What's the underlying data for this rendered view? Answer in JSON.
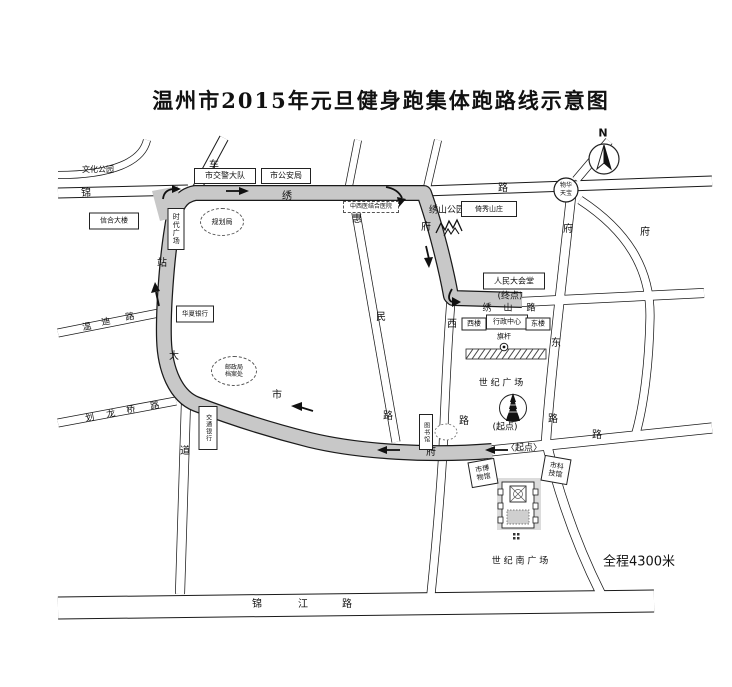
{
  "title": "温州市2015年元旦健身跑集体跑路线示意图",
  "map": {
    "route_color": "#c8c8c8",
    "road_color": "#ffffff",
    "labels": [
      {
        "n": "culture-park-label",
        "t": "文化公园",
        "x": 98,
        "y": 170,
        "fs": 8
      },
      {
        "n": "chezhan-dadao-char-1",
        "t": "车",
        "x": 214,
        "y": 166,
        "fs": 10
      },
      {
        "n": "jinxiu-lu-char-1",
        "t": "锦",
        "x": 86,
        "y": 194,
        "fs": 10
      },
      {
        "n": "jinxiu-lu-char-2",
        "t": "绣",
        "x": 287,
        "y": 197,
        "fs": 10
      },
      {
        "n": "jinxiu-lu-char-3",
        "t": "路",
        "x": 503,
        "y": 189,
        "fs": 10
      },
      {
        "n": "chezhan-dadao-char-2",
        "t": "站",
        "x": 162,
        "y": 264,
        "fs": 10
      },
      {
        "n": "chezhan-dadao-char-3",
        "t": "大",
        "x": 174,
        "y": 357,
        "fs": 10
      },
      {
        "n": "chezhan-dadao-char-4",
        "t": "道",
        "x": 185,
        "y": 452,
        "fs": 10
      },
      {
        "n": "wendi-lu-char-1",
        "t": "温",
        "x": 87,
        "y": 328,
        "fs": 9,
        "r": -10
      },
      {
        "n": "wendi-lu-char-2",
        "t": "迪",
        "x": 106,
        "y": 323,
        "fs": 9,
        "r": -10
      },
      {
        "n": "wendi-lu-char-3",
        "t": "路",
        "x": 130,
        "y": 318,
        "fs": 9,
        "r": -10
      },
      {
        "n": "hualongqiao-lu-char-1",
        "t": "划",
        "x": 90,
        "y": 419,
        "fs": 9,
        "r": -10
      },
      {
        "n": "hualongqiao-lu-char-2",
        "t": "龙",
        "x": 111,
        "y": 415,
        "fs": 9,
        "r": -10
      },
      {
        "n": "hualongqiao-lu-char-3",
        "t": "桥",
        "x": 131,
        "y": 411,
        "fs": 9,
        "r": -10
      },
      {
        "n": "hualongqiao-lu-char-4",
        "t": "路",
        "x": 155,
        "y": 407,
        "fs": 9,
        "r": -10
      },
      {
        "n": "shifu-lu-char-1",
        "t": "市",
        "x": 277,
        "y": 396,
        "fs": 10
      },
      {
        "n": "shifu-lu-char-2",
        "t": "府",
        "x": 431,
        "y": 453,
        "fs": 10
      },
      {
        "n": "shifu-lu-char-3",
        "t": "路",
        "x": 597,
        "y": 436,
        "fs": 10
      },
      {
        "n": "huimin-lu-char-1",
        "t": "惠",
        "x": 357,
        "y": 220,
        "fs": 10
      },
      {
        "n": "huimin-lu-char-2",
        "t": "民",
        "x": 381,
        "y": 318,
        "fs": 10
      },
      {
        "n": "huimin-lu-char-3",
        "t": "路",
        "x": 388,
        "y": 417,
        "fs": 10
      },
      {
        "n": "fuxi-lu-char-1",
        "t": "府",
        "x": 426,
        "y": 228,
        "fs": 10
      },
      {
        "n": "fuxi-lu-char-2",
        "t": "西",
        "x": 452,
        "y": 325,
        "fs": 10
      },
      {
        "n": "fuxi-lu-char-3",
        "t": "路",
        "x": 464,
        "y": 422,
        "fs": 10
      },
      {
        "n": "fudong-lu-char-1",
        "t": "府",
        "x": 568,
        "y": 230,
        "fs": 10
      },
      {
        "n": "fudong-lu-char-2",
        "t": "东",
        "x": 556,
        "y": 344,
        "fs": 10
      },
      {
        "n": "fudong-lu-char-3",
        "t": "路",
        "x": 553,
        "y": 420,
        "fs": 10
      },
      {
        "n": "east-road-char",
        "t": "府",
        "x": 645,
        "y": 233,
        "fs": 10
      },
      {
        "n": "xiushan-lu-char-1",
        "t": "绣",
        "x": 487,
        "y": 309,
        "fs": 9
      },
      {
        "n": "xiushan-lu-char-2",
        "t": "山",
        "x": 508,
        "y": 309,
        "fs": 9
      },
      {
        "n": "xiushan-lu-char-3",
        "t": "路",
        "x": 531,
        "y": 309,
        "fs": 9
      },
      {
        "n": "jinjiang-lu-char-1",
        "t": "锦",
        "x": 257,
        "y": 605,
        "fs": 10
      },
      {
        "n": "jinjiang-lu-char-2",
        "t": "江",
        "x": 303,
        "y": 605,
        "fs": 10
      },
      {
        "n": "jinjiang-lu-char-3",
        "t": "路",
        "x": 347,
        "y": 605,
        "fs": 10
      },
      {
        "n": "xiushan-park-label",
        "t": "绣山公园",
        "x": 447,
        "y": 211,
        "fs": 9
      },
      {
        "n": "finish-point-label",
        "t": "(终点)",
        "x": 510,
        "y": 297,
        "fs": 9
      },
      {
        "n": "century-square-label",
        "t": "世 纪 广 场",
        "x": 501,
        "y": 384,
        "fs": 9
      },
      {
        "n": "start-point-label-1",
        "t": "(起点)",
        "x": 505,
        "y": 428,
        "fs": 9
      },
      {
        "n": "start-point-label-2",
        "t": "〈起点〉",
        "x": 524,
        "y": 449,
        "fs": 9
      },
      {
        "n": "flagpole-label",
        "t": "旗杆",
        "x": 504,
        "y": 337,
        "fs": 7
      },
      {
        "n": "century-south-square-label",
        "t": "世 纪 南 广 场",
        "x": 520,
        "y": 562,
        "fs": 9
      },
      {
        "n": "total-distance-label",
        "t": "全程4300米",
        "x": 639,
        "y": 562,
        "fs": 13
      },
      {
        "n": "compass-n-label",
        "t": "N",
        "x": 603,
        "y": 133,
        "fs": 11,
        "b": 1
      }
    ],
    "boxes": [
      {
        "n": "traffic-police-box",
        "lines": [
          "市交警大队"
        ],
        "x": 225,
        "y": 176,
        "w": 62,
        "h": 16,
        "fs": 8
      },
      {
        "n": "public-security-box",
        "lines": [
          "市公安局"
        ],
        "x": 286,
        "y": 176,
        "w": 50,
        "h": 16,
        "fs": 8
      },
      {
        "n": "xinhe-building-box",
        "lines": [
          "信合大楼"
        ],
        "x": 114,
        "y": 221,
        "w": 50,
        "h": 17,
        "fs": 7
      },
      {
        "n": "times-square-box",
        "lines": [
          "时代广场"
        ],
        "x": 176,
        "y": 229,
        "w": 17,
        "h": 42,
        "fs": 7,
        "v": 1
      },
      {
        "n": "hospital-box",
        "lines": [
          "中西医结合医院"
        ],
        "x": 371,
        "y": 207,
        "w": 56,
        "h": 12,
        "fs": 6,
        "dash": 1
      },
      {
        "n": "yixiu-villa-box",
        "lines": [
          "倚秀山庄"
        ],
        "x": 489,
        "y": 209,
        "w": 56,
        "h": 16,
        "fs": 7
      },
      {
        "n": "great-hall-box",
        "lines": [
          "人民大会堂"
        ],
        "x": 514,
        "y": 281,
        "w": 62,
        "h": 17,
        "fs": 8
      },
      {
        "n": "huaxia-bank-box",
        "lines": [
          "华夏银行"
        ],
        "x": 195,
        "y": 314,
        "w": 38,
        "h": 17,
        "fs": 6.5
      },
      {
        "n": "jiaotong-bank-box",
        "lines": [
          "交通银行"
        ],
        "x": 208,
        "y": 428,
        "w": 19,
        "h": 44,
        "fs": 6,
        "v": 1
      },
      {
        "n": "west-building-box",
        "lines": [
          "西楼"
        ],
        "x": 474,
        "y": 324,
        "w": 25,
        "h": 13,
        "fs": 7
      },
      {
        "n": "admin-center-box",
        "lines": [
          "行政中心"
        ],
        "x": 507,
        "y": 322,
        "w": 42,
        "h": 15,
        "fs": 7
      },
      {
        "n": "east-building-box",
        "lines": [
          "东楼"
        ],
        "x": 538,
        "y": 324,
        "w": 25,
        "h": 13,
        "fs": 7
      },
      {
        "n": "museum-box",
        "lines": [
          "市博",
          "物馆"
        ],
        "x": 483,
        "y": 473,
        "w": 27,
        "h": 26,
        "fs": 7,
        "r": -10
      },
      {
        "n": "science-museum-box",
        "lines": [
          "市科",
          "技馆"
        ],
        "x": 556,
        "y": 470,
        "w": 27,
        "h": 26,
        "fs": 7,
        "r": 10
      },
      {
        "n": "library-box",
        "lines": [
          "图书馆"
        ],
        "x": 426,
        "y": 432,
        "w": 14,
        "h": 36,
        "fs": 6,
        "v": 1
      },
      {
        "n": "planning-bureau-ellipse",
        "lines": [
          "规划局"
        ],
        "x": 222,
        "y": 222,
        "w": 44,
        "h": 28,
        "fs": 7,
        "dash": 1,
        "ell": 1
      },
      {
        "n": "post-archive-ellipse",
        "lines": [
          "邮政局",
          "档案处"
        ],
        "x": 234,
        "y": 371,
        "w": 46,
        "h": 30,
        "fs": 6,
        "dash": 1,
        "ell": 1
      },
      {
        "n": "roundabout-label",
        "lines": [
          "物华",
          "天宝"
        ],
        "x": 566,
        "y": 190,
        "w": 24,
        "h": 20,
        "fs": 6,
        "plain": 1
      }
    ]
  }
}
